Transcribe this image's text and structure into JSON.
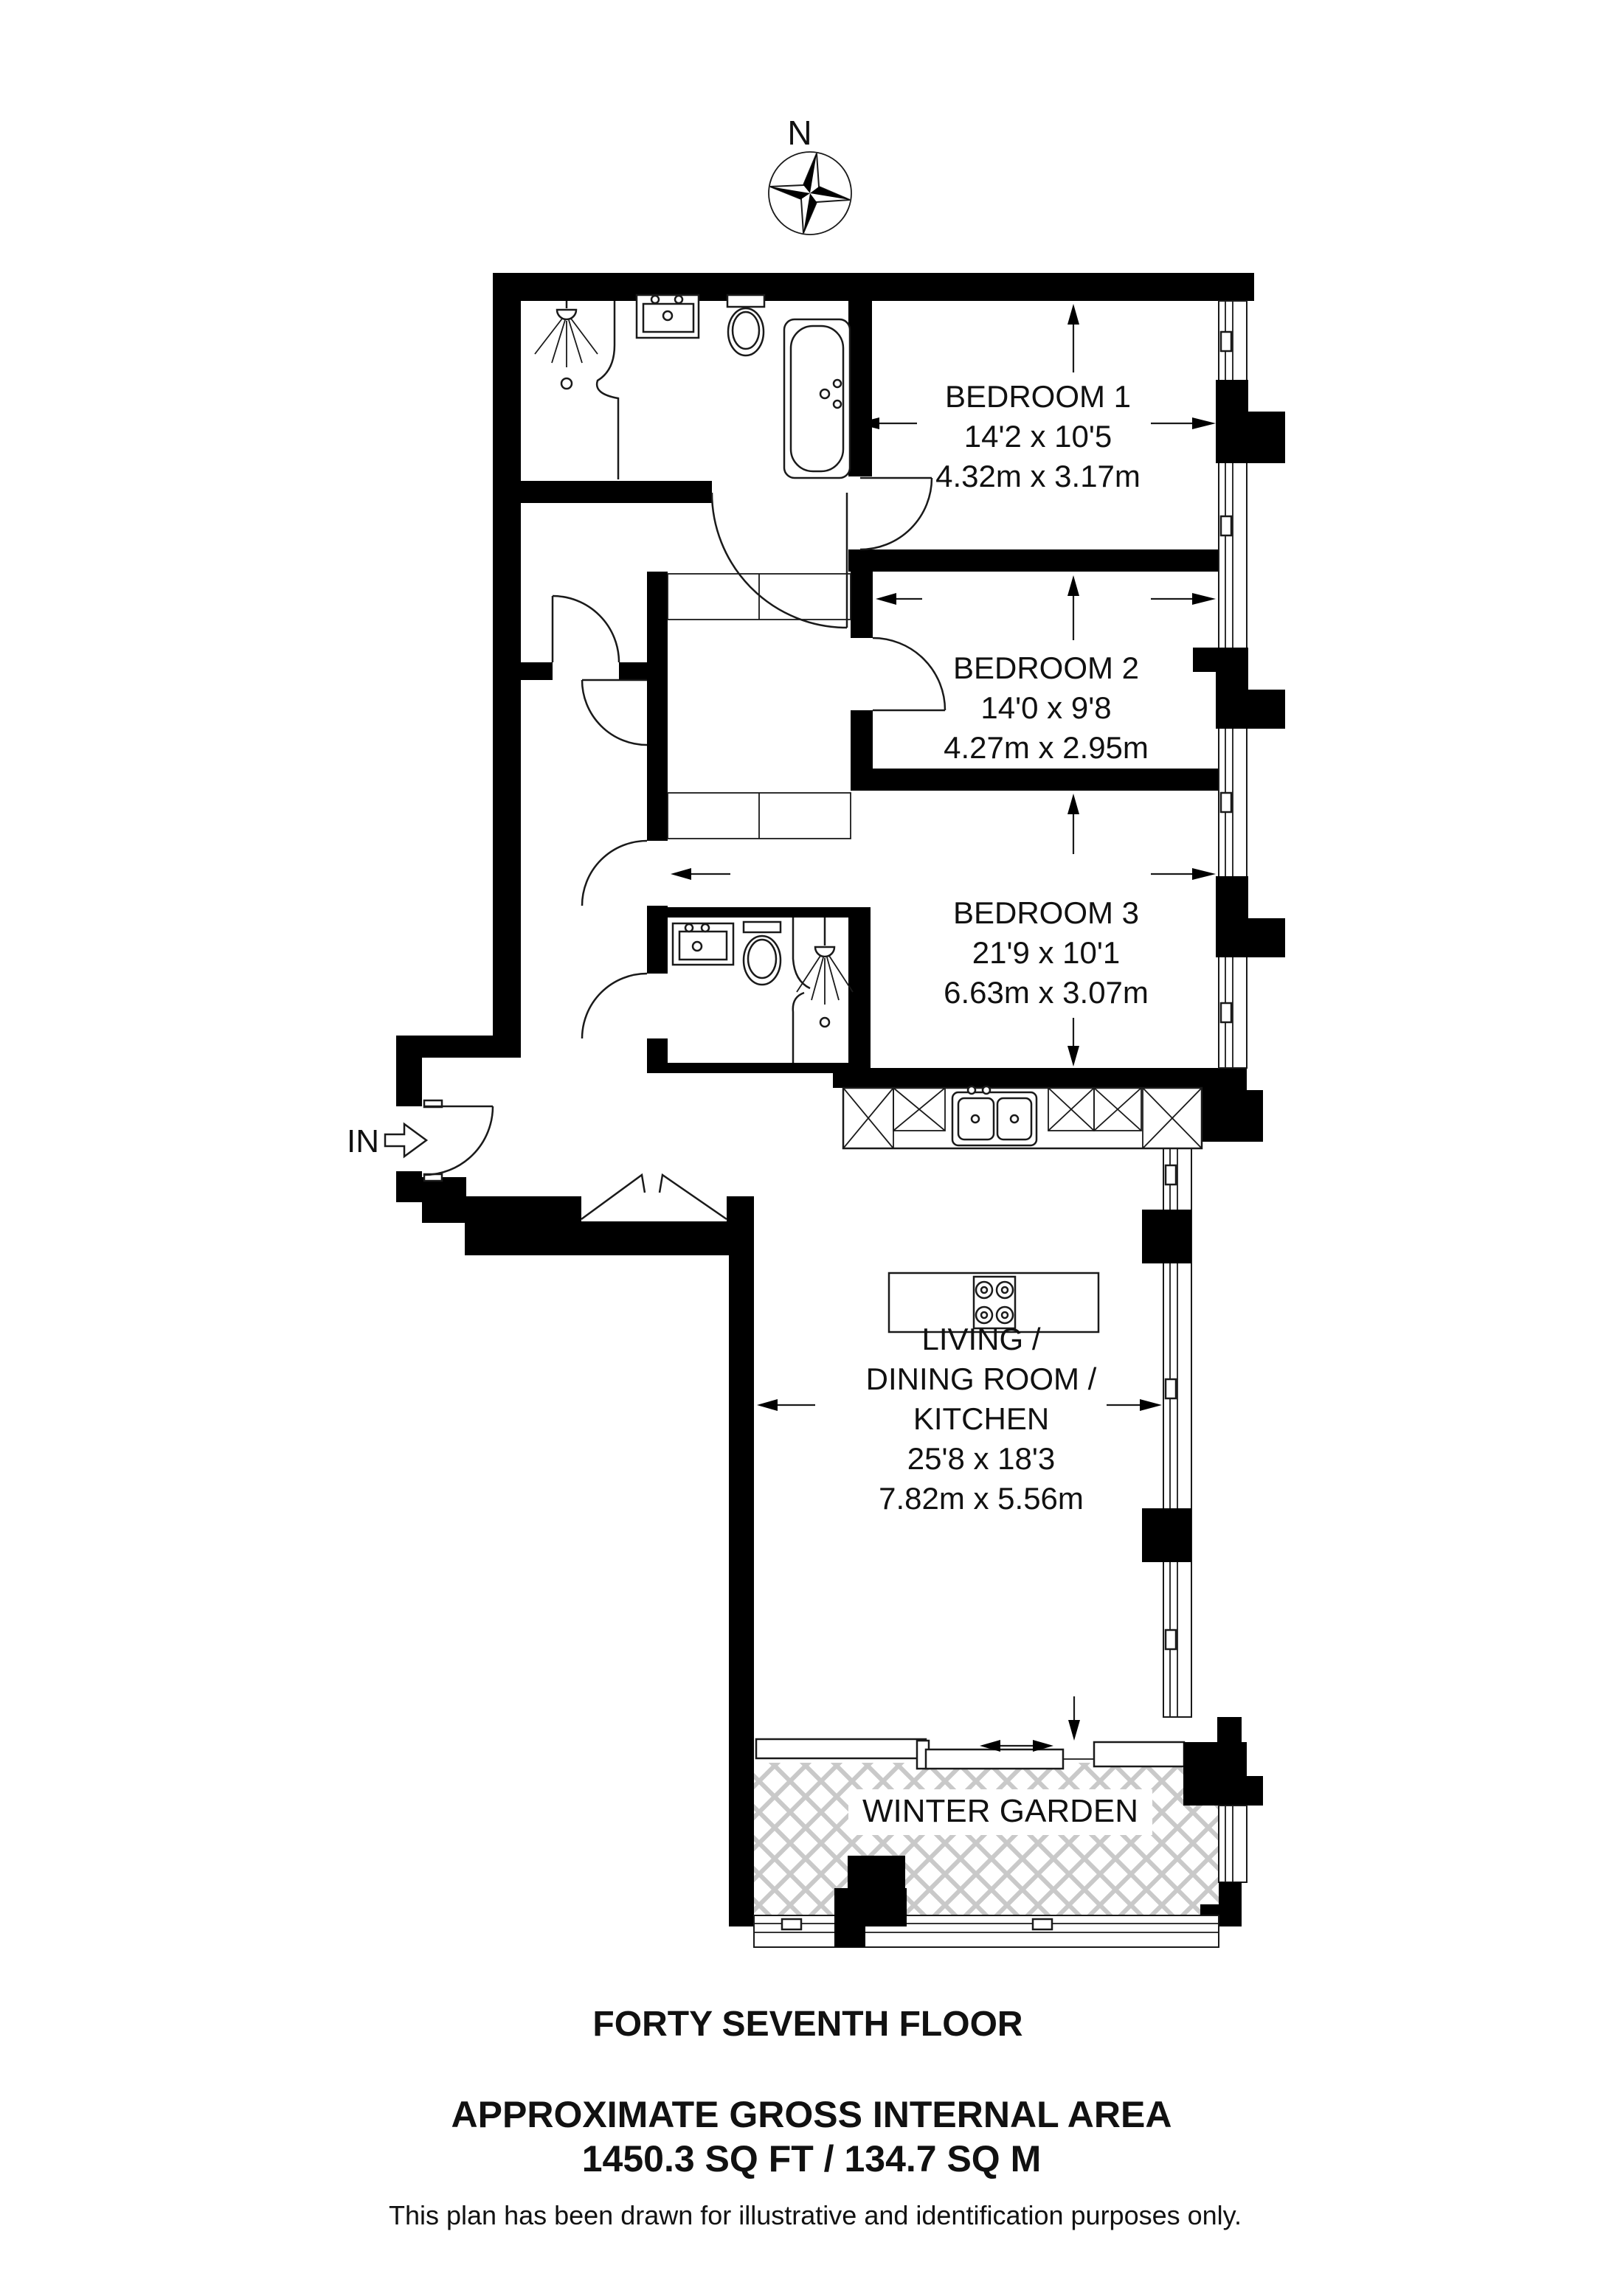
{
  "compass": {
    "north_label": "N"
  },
  "entrance": {
    "label": "IN"
  },
  "rooms": {
    "bedroom1": {
      "name": "BEDROOM 1",
      "imperial": "14'2 x 10'5",
      "metric": "4.32m x 3.17m"
    },
    "bedroom2": {
      "name": "BEDROOM 2",
      "imperial": "14'0 x 9'8",
      "metric": "4.27m x 2.95m"
    },
    "bedroom3": {
      "name": "BEDROOM 3",
      "imperial": "21'9 x 10'1",
      "metric": "6.63m x 3.07m"
    },
    "living": {
      "line1": "LIVING /",
      "line2": "DINING ROOM /",
      "line3": "KITCHEN",
      "imperial": "25'8 x 18'3",
      "metric": "7.82m x 5.56m"
    },
    "winter_garden": {
      "name": "WINTER GARDEN"
    }
  },
  "footer": {
    "floor": "FORTY SEVENTH FLOOR",
    "area_title": "APPROXIMATE GROSS INTERNAL AREA",
    "area_value": "1450.3 SQ FT / 134.7 SQ M",
    "disclaimer": "This plan has been drawn for illustrative and identification purposes only."
  },
  "colors": {
    "wall": "#000000",
    "hatch": "#c9c9c9",
    "background": "#ffffff"
  }
}
